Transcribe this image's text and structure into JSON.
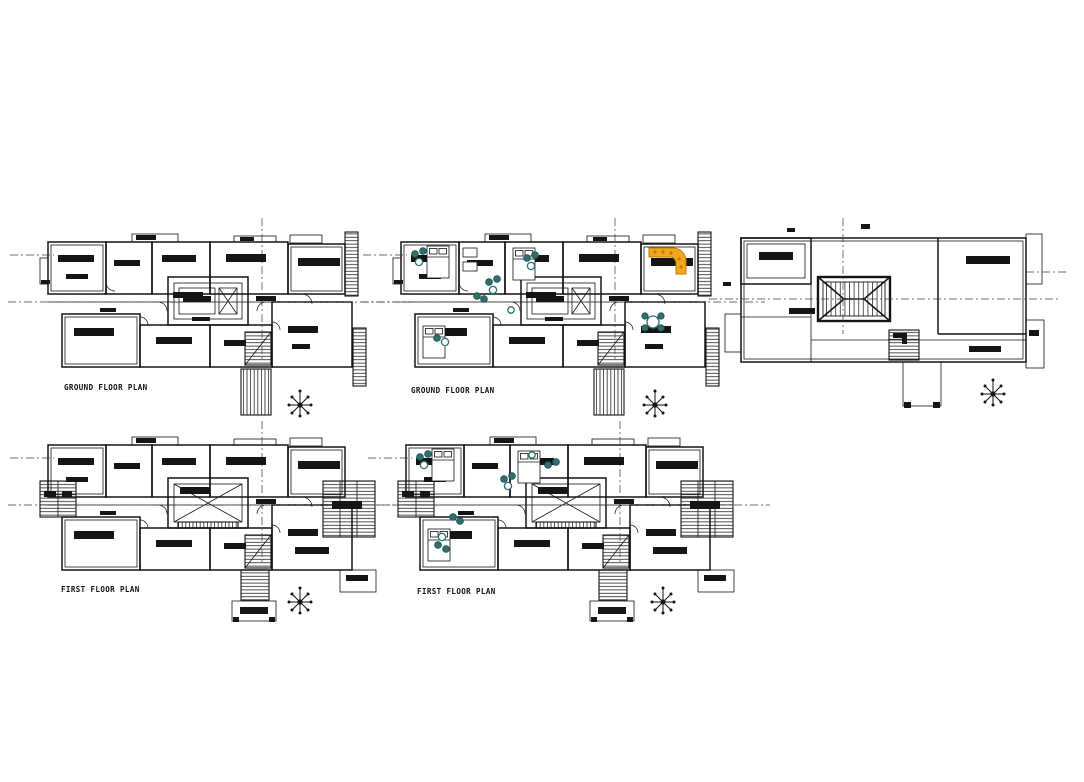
{
  "sheet": {
    "background": "#ffffff"
  },
  "colors": {
    "line": "#151515",
    "dash": "#3c3c3c",
    "furniture_teal": "#2f6f6d",
    "furniture_teal_dark": "#1c4f4e",
    "sofa_yellow": "#f0a820",
    "sofa_outline": "#c07c00"
  },
  "plans": [
    {
      "id": "ground-floor-unfurnished",
      "title": "GROUND FLOOR PLAN",
      "furnished": false,
      "position": "top-left"
    },
    {
      "id": "ground-floor-furnished",
      "title": "GROUND FLOOR PLAN",
      "furnished": true,
      "position": "top-middle"
    },
    {
      "id": "terrace-plan",
      "title": "",
      "furnished": false,
      "position": "top-right"
    },
    {
      "id": "first-floor-unfurnished",
      "title": "FIRST FLOOR PLAN",
      "furnished": false,
      "position": "bottom-left"
    },
    {
      "id": "first-floor-furnished",
      "title": "FIRST FLOOR PLAN",
      "furnished": true,
      "position": "bottom-middle"
    }
  ],
  "icons": {
    "north_star": "8-arm-compass-asterisk",
    "room_label": "solid-black-bar",
    "stair": "parallel-tread-hatch"
  }
}
